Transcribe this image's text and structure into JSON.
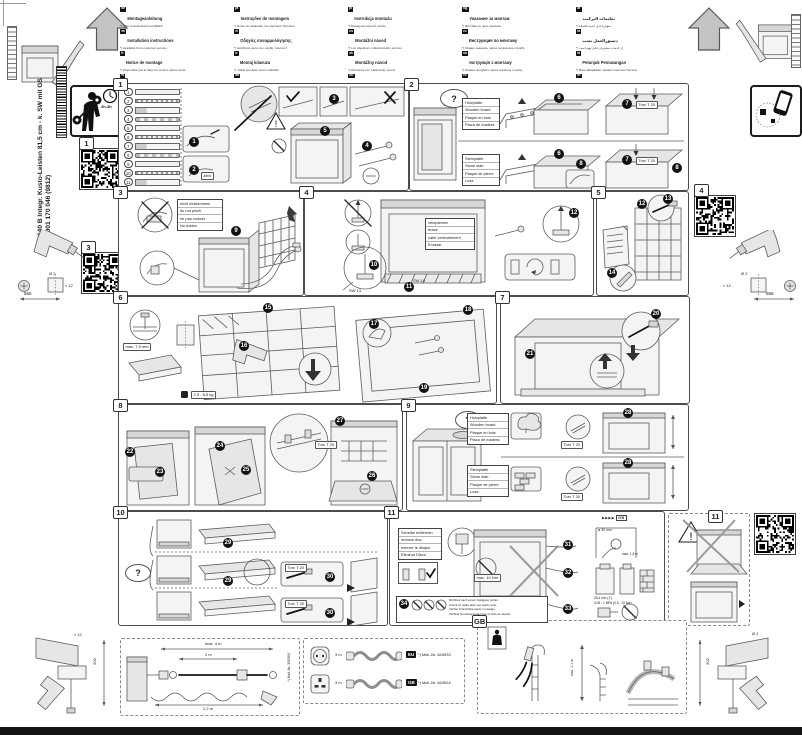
{
  "doc": {
    "model": "640 B Integr. Kusto-Leisten 81,5 cm - k. SW mit GS",
    "order_number": "9001 170 046 (9812)",
    "install_time": "2h-3h",
    "qr": {
      "one": "1",
      "three": "3",
      "four": "4",
      "eleven": "11"
    }
  },
  "header": {
    "columns": [
      [
        {
          "code": "de",
          "title": "Montageanleitung",
          "note": "*) Über Kundendienst erhältlich"
        },
        {
          "code": "en",
          "title": "Installation instructions",
          "note": "*) Available from customer service"
        },
        {
          "code": "fr",
          "title": "Notice de montage",
          "note": "*) Disponible par le biais du service après-vente"
        },
        {
          "code": "nl",
          "title": "Montagevoorschrift",
          "note": "*) Te bestellen bij de servicedienst"
        },
        {
          "code": "it",
          "title": "Istruzioni per il montaggio",
          "note": "*) Disponibili presso il servizio assistenza"
        },
        {
          "code": "es",
          "title": "Instrucciones de montaje",
          "note": "*) Disponible a través del servicio técnico"
        }
      ],
      [
        {
          "code": "pt",
          "title": "Instruções de montagem",
          "note": "*) Pode ser adquirido nos Serviços Técnicos"
        },
        {
          "code": "el",
          "title": "Οδηγίες συναρμολόγησης",
          "note": "*) Διατίθεται μέσω του σέρβις πελατών"
        },
        {
          "code": "tr",
          "title": "Montaj kılavuzu",
          "note": "*) Yetkili servisten temin edilebilir"
        },
        {
          "code": "da",
          "title": "Monteringsvejledning",
          "note": "*) Fås via serviceafdelingen"
        },
        {
          "code": "sv",
          "title": "Monteringsanvisning",
          "note": "*) Kan beställas hos servicetjänsten"
        },
        {
          "code": "no",
          "title": "Monteringsveiledning",
          "note": "*) Fås hos kundeservice"
        },
        {
          "code": "fi",
          "title": "Asennusohje",
          "note": "*) Saatavana huoltopalvelusta"
        }
      ],
      [
        {
          "code": "pl",
          "title": "Instrukcja montażu",
          "note": "*) Dostępna poprzez serwis"
        },
        {
          "code": "cs",
          "title": "Montážní návod",
          "note": "*) Lze objednat u zákaznického servisu"
        },
        {
          "code": "sk",
          "title": "Montážny náv­od",
          "note": "*) Dostupný cez zákaznícky servis"
        },
        {
          "code": "hu",
          "title": "Szerelési útmutató",
          "note": "*) Az ügyfélszolgálaton keresztül kapható"
        },
        {
          "code": "hr",
          "title": "Upute za montažu",
          "note": "*) Može se nabaviti preko servisne službe"
        },
        {
          "code": "sl",
          "title": "Navodila za montažo",
          "note": "*) Na voljo prek servisne službe"
        },
        {
          "code": "sr",
          "title": "Uputstvo za montažu",
          "note": "*) Dostupno preko servisne službe"
        }
      ],
      [
        {
          "code": "bg",
          "title": "Указание за монтаж",
          "note": "*) Доставя се чрез сервиза"
        },
        {
          "code": "ru",
          "title": "Инструкция по монтажу",
          "note": "*) Можно заказать через сервисную службу"
        },
        {
          "code": "uk",
          "title": "Інструкція з монтажу",
          "note": "*) Можна придбати через сервісну службу"
        },
        {
          "code": "ro",
          "title": "Instrucţiuni de montaj",
          "note": "*) Disponibile prin unităţile service"
        },
        {
          "code": "et",
          "title": "Paigaldusjuhend",
          "note": "*) Saadaval klienditeeninduse kaudu"
        },
        {
          "code": "lv",
          "title": "Montāžas instrukcija",
          "note": "*) Pieejama klientu servisā"
        },
        {
          "code": "lt",
          "title": "Montavimo instrukcija",
          "note": "*) Galima įsigyti klientų aptarnavimo skyriuje"
        }
      ],
      [
        {
          "code": "ar",
          "title": "تعليمات التركيب",
          "note": "*) متوفرة لدى خدمة العملاء"
        },
        {
          "code": "fa",
          "title": "دستورالعمل نصب",
          "note": "*) از خدمات مشتریان قابل تهیه است"
        },
        {
          "code": "id",
          "title": "Petunjuk Pemasangan",
          "note": "*) Bisa didapatkan melalui Customer Service"
        },
        {
          "code": "th",
          "title": "คำแนะนำการติดตั้ง",
          "note": "*) มีให้ที่ศูนย์บริการลูกค้า"
        },
        {
          "code": "ko",
          "title": "설치 설명서",
          "note": "*) 고객센터에서 구입 가능"
        },
        {
          "code": "zh",
          "title": "安装说明",
          "note": "*) 可向售后服务部门索取"
        },
        {
          "code": "zh",
          "title": "安裝說明",
          "note": "*) 可向客戶服務部門索取"
        }
      ]
    ]
  },
  "steps": [
    "1",
    "2",
    "3",
    "4",
    "5",
    "6",
    "7",
    "8",
    "9",
    "10",
    "11",
    "12",
    "13",
    "14",
    "15",
    "16",
    "17",
    "18",
    "19",
    "20",
    "21",
    "22",
    "23",
    "24",
    "25",
    "26",
    "27",
    "28",
    "29",
    "30",
    "31",
    "32",
    "33",
    "34"
  ],
  "labels": {
    "torx": "Torx T 20",
    "sw13": "SW 13",
    "sw10": "SW 10",
    "klick": "klick",
    "question": "?",
    "max_torque": "max. 10 Nm",
    "gb": "GB",
    "gb_arrows": "▶▶▶▶",
    "weight": "2,5 - 8,5 kg",
    "screw_depth": "max. 7,5 mm",
    "hole": "ø 30 mm",
    "hose_height": "max. 1,5 m",
    "adapter1": "25,4 mm (1\")",
    "adapter2": "20,6 mm (3/4\")",
    "pressure": "0,05 - 1 MPa (0,5 - 10 bar)",
    "temp": "max. 60 °C"
  },
  "panels": {
    "p1": {
      "num": "1",
      "parts": [
        {
          "no": "1",
          "icon": "fixing-strip"
        },
        {
          "no": "2",
          "icon": "clamp"
        },
        {
          "no": "3",
          "icon": "screw"
        },
        {
          "no": "4",
          "icon": "bracket"
        },
        {
          "no": "5",
          "icon": "screw-pair"
        },
        {
          "no": "6",
          "icon": "felt-pad"
        },
        {
          "no": "7",
          "icon": "screw-set"
        },
        {
          "no": "8",
          "icon": "screw-set"
        },
        {
          "no": "9",
          "icon": "cover-strip"
        },
        {
          "no": "10",
          "icon": "angle-bracket"
        },
        {
          "no": "11",
          "icon": "cover-cap"
        }
      ]
    },
    "p2": {
      "num": "2",
      "wood": [
        "Holzplatte",
        "Wooden board",
        "Plaque en bois",
        "Placa de madera"
      ],
      "stone": [
        "Steinplatte",
        "Stone slab",
        "Plaque de pierre",
        "Losa"
      ]
    },
    "p3": {
      "num": "3",
      "note": [
        "nicht einklemmen",
        "do not pinch",
        "ne pas coincer",
        "No doblar"
      ]
    },
    "p4": {
      "num": "4",
      "note": [
        "verspannen",
        "brace",
        "caler verticalement",
        "Enrasar"
      ]
    },
    "p5": {
      "num": "5"
    },
    "p6": {
      "num": "6"
    },
    "p7": {
      "num": "7"
    },
    "p8": {
      "num": "8"
    },
    "p9": {
      "num": "9",
      "wood": [
        "Holzplatte",
        "Wooden board",
        "Plaque en bois",
        "Placa de madera"
      ],
      "stone": [
        "Steinplatte",
        "Stone slab",
        "Plaque de pierre",
        "Losa"
      ]
    },
    "p10": {
      "num": "10"
    },
    "p11": {
      "num": "11",
      "note_disc": [
        "Scheibe entfernen",
        "remove disc",
        "enlever le disque",
        "Eliminar Disco"
      ],
      "leak_note": [
        "Dichtheit nach einem Spülgang prüfen",
        "Check for leaks after one wash cycle.",
        "Vérifier l'étanchéité après un lavage.",
        "Verificar la estanqueidad tras un ciclo de lavado."
      ]
    }
  },
  "bottom": {
    "hose_box": {
      "total": "max. 4 m",
      "supply": "2 m",
      "drain": "2,2 m",
      "mat": "*) Mat.-Nr. 350564"
    },
    "cord_box": {
      "rows": [
        {
          "plug": "EU",
          "length": "3 m",
          "mat": "*) Mat.-Nr. 644533"
        },
        {
          "plug": "GB",
          "length": "3 m",
          "mat": "*) Mat.-Nr. 644524"
        }
      ]
    },
    "gb_box": {
      "label": "GB",
      "drain_height": "max. 1,1 m"
    }
  },
  "side": {
    "drill_dia": "Ø 2",
    "pilot_depth": "≈ 12",
    "dim_upper": "566",
    "dim_lower": "502"
  }
}
